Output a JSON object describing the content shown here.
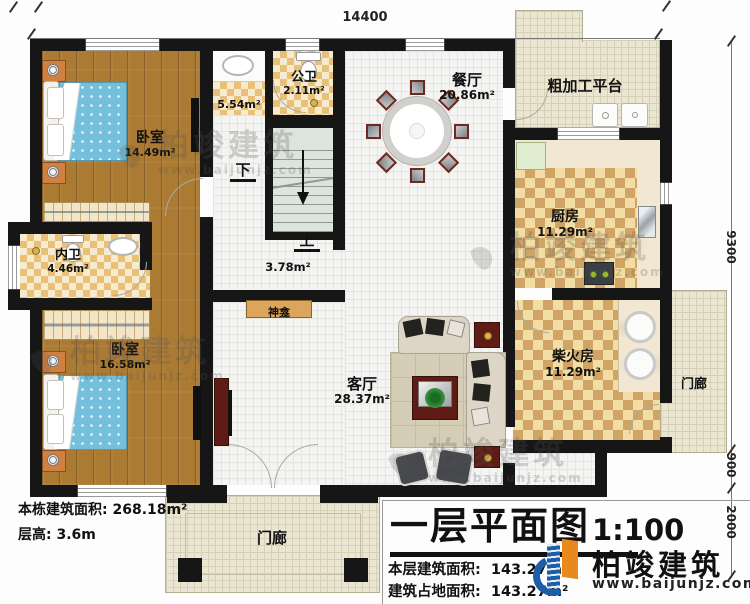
{
  "dimensions": {
    "top": "14400",
    "right_a": "9300",
    "right_b": "900",
    "right_c": "2000"
  },
  "rooms": {
    "bedroom1": {
      "name": "卧室",
      "area": "14.49m²"
    },
    "vanity": {
      "area": "5.54m²"
    },
    "public_wc": {
      "name": "公卫",
      "area": "2.11m²"
    },
    "dining": {
      "name": "餐厅",
      "area": "20.86m²"
    },
    "platform": {
      "name": "粗加工平台"
    },
    "kitchen": {
      "name": "厨房",
      "area": "11.29m²"
    },
    "inner_wc": {
      "name": "内卫",
      "area": "4.46m²"
    },
    "bedroom2": {
      "name": "卧室",
      "area": "16.58m²"
    },
    "living": {
      "name": "客厅",
      "area": "28.37m²"
    },
    "firewood": {
      "name": "柴火房",
      "area": "11.29m²"
    },
    "porch_right": {
      "name": "门廊"
    },
    "porch_bottom": {
      "name": "门廊"
    },
    "hall": {
      "area": "3.78m²"
    },
    "shrine": {
      "name": "神龛"
    },
    "stairs": {
      "up": "上",
      "down": "下"
    }
  },
  "notes": {
    "total_area": "本栋建筑面积: 268.18m²",
    "floor_height": "层高: 3.6m"
  },
  "title_block": {
    "title": "一层平面图",
    "scale": "1:100",
    "floor_area_label": "本层建筑面积:",
    "floor_area_value": "143.27m²",
    "footprint_label": "建筑占地面积:",
    "footprint_value": "143.27m²",
    "brand": "柏竣建筑",
    "website": "www.baijunjz.com"
  },
  "watermark": {
    "brand": "柏竣建筑",
    "website": "www.baijunjz.com"
  },
  "colors": {
    "wall": "#161616",
    "brand_blue": "#1c5fa8",
    "brand_orange": "#e8891d"
  }
}
